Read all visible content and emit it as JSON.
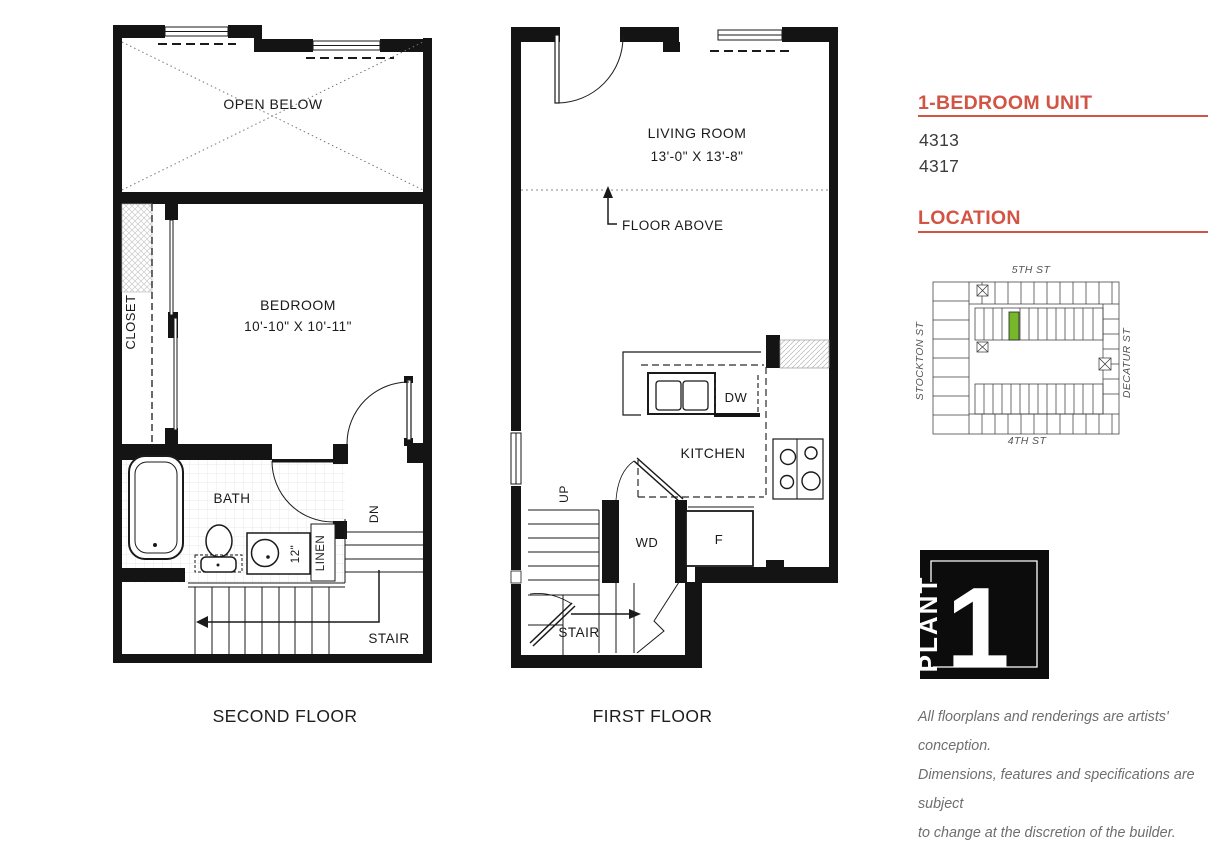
{
  "colors": {
    "accent": "#d25445",
    "green": "#76b82a",
    "ink": "#1a1a1a",
    "gray_text": "#6e6e6e"
  },
  "sidebar": {
    "unit_heading": "1-BEDROOM UNIT",
    "unit_numbers": [
      "4313",
      "4317"
    ],
    "location_heading": "LOCATION",
    "map": {
      "street_top": "5TH ST",
      "street_left": "STOCKTON ST",
      "street_right": "DECATUR ST",
      "street_bottom": "4TH ST"
    },
    "logo": {
      "word": "PLANT",
      "number": "1"
    },
    "disclaimer_lines": [
      "All floorplans and renderings are artists' conception.",
      "Dimensions, features and specifications are subject",
      "to change at the discretion of the builder."
    ]
  },
  "second_floor": {
    "caption": "SECOND FLOOR",
    "labels": {
      "open_below": "OPEN BELOW",
      "closet": "CLOSET",
      "bedroom": "BEDROOM",
      "bedroom_dims": "10'-10\" X 10'-11\"",
      "bath": "BATH",
      "linen_depth": "12\"",
      "linen": "LINEN",
      "dn": "DN",
      "stair": "STAIR"
    }
  },
  "first_floor": {
    "caption": "FIRST FLOOR",
    "labels": {
      "living_room": "LIVING ROOM",
      "living_dims": "13'-0\" X 13'-8\"",
      "floor_above": "FLOOR ABOVE",
      "kitchen": "KITCHEN",
      "dw": "DW",
      "wd": "WD",
      "fridge": "F",
      "up": "UP",
      "stair": "STAIR"
    }
  }
}
